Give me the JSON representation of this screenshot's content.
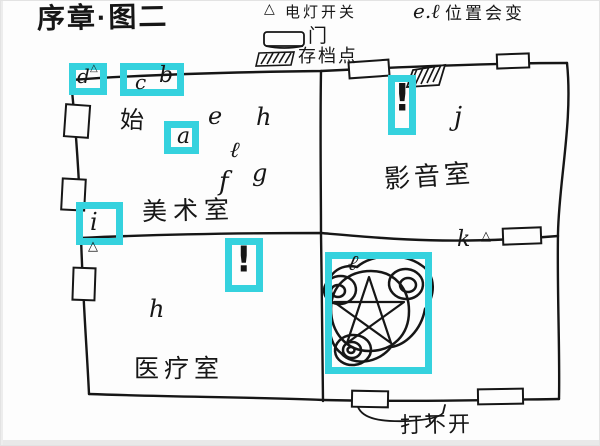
{
  "title": "序章·图二",
  "legend": {
    "light_switch": {
      "symbol": "△",
      "label": "电灯开关"
    },
    "moving_note": {
      "keys": "e.ℓ",
      "label": "位置会变"
    },
    "door": {
      "label": "门"
    },
    "save_point": {
      "label": "存档点"
    }
  },
  "rooms": {
    "art": "美术室",
    "av": "影音室",
    "medical": "医疗室"
  },
  "markers": {
    "start": "始",
    "a": "a",
    "b": "b",
    "c": "c",
    "d": "d",
    "e": "e",
    "f": "f",
    "g": "g",
    "h_art": "h",
    "l_art": "ℓ",
    "i": "i",
    "j": "j",
    "k": "k",
    "h_medical": "h",
    "l_ritual": "ℓ",
    "alert_art": "!",
    "alert_av": "!",
    "switch_symbol": "△"
  },
  "notes": {
    "locked_door": "打不开"
  },
  "colors": {
    "highlight": "#35d2de",
    "ink": "#161616"
  }
}
